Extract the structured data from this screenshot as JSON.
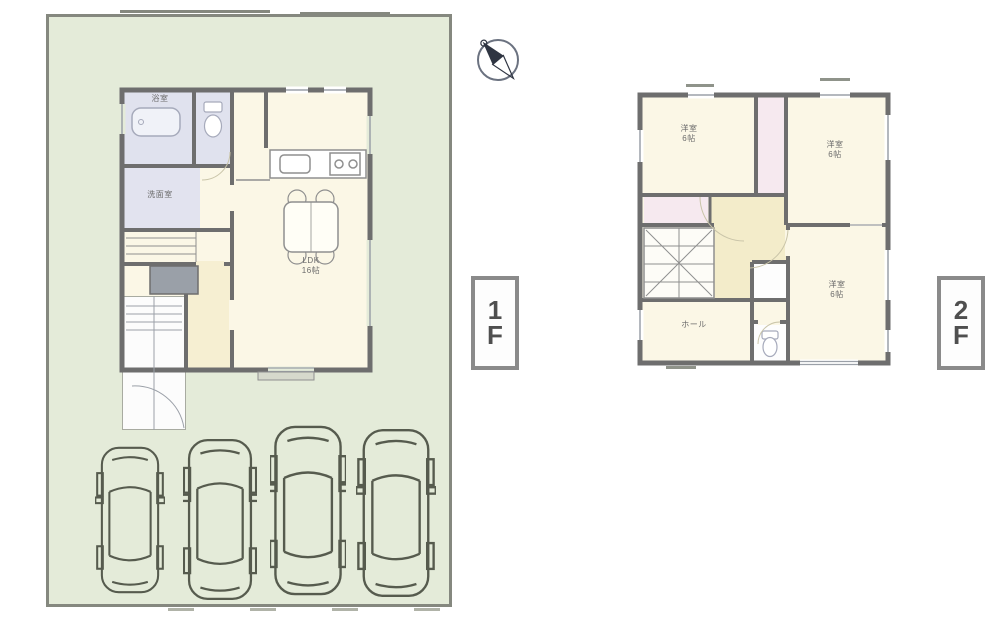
{
  "floor1": {
    "tag": {
      "top": "1",
      "bottom": "F"
    },
    "labels": {
      "bath": "浴室",
      "washroom": "洗面室",
      "ldk_title": "LDK",
      "ldk_size": "16帖"
    },
    "parking_car_count": 4
  },
  "floor2": {
    "tag": {
      "top": "2",
      "bottom": "F"
    },
    "labels": {
      "room_nw_title": "洋室",
      "room_nw_size": "6帖",
      "room_ne_title": "洋室",
      "room_ne_size": "6帖",
      "room_se_title": "洋室",
      "room_se_size": "6帖",
      "hall": "ホール"
    }
  },
  "icons": {
    "compass": "north-arrow-icon"
  },
  "colors": {
    "site_green": "#e4ebd9",
    "wall_gray": "#6e6e6e",
    "room_cream": "#fbf7e6",
    "wet_lavender": "#e0e2ee",
    "closet_pink": "#f6e9ef",
    "hall_yellow": "#f3ecca"
  }
}
